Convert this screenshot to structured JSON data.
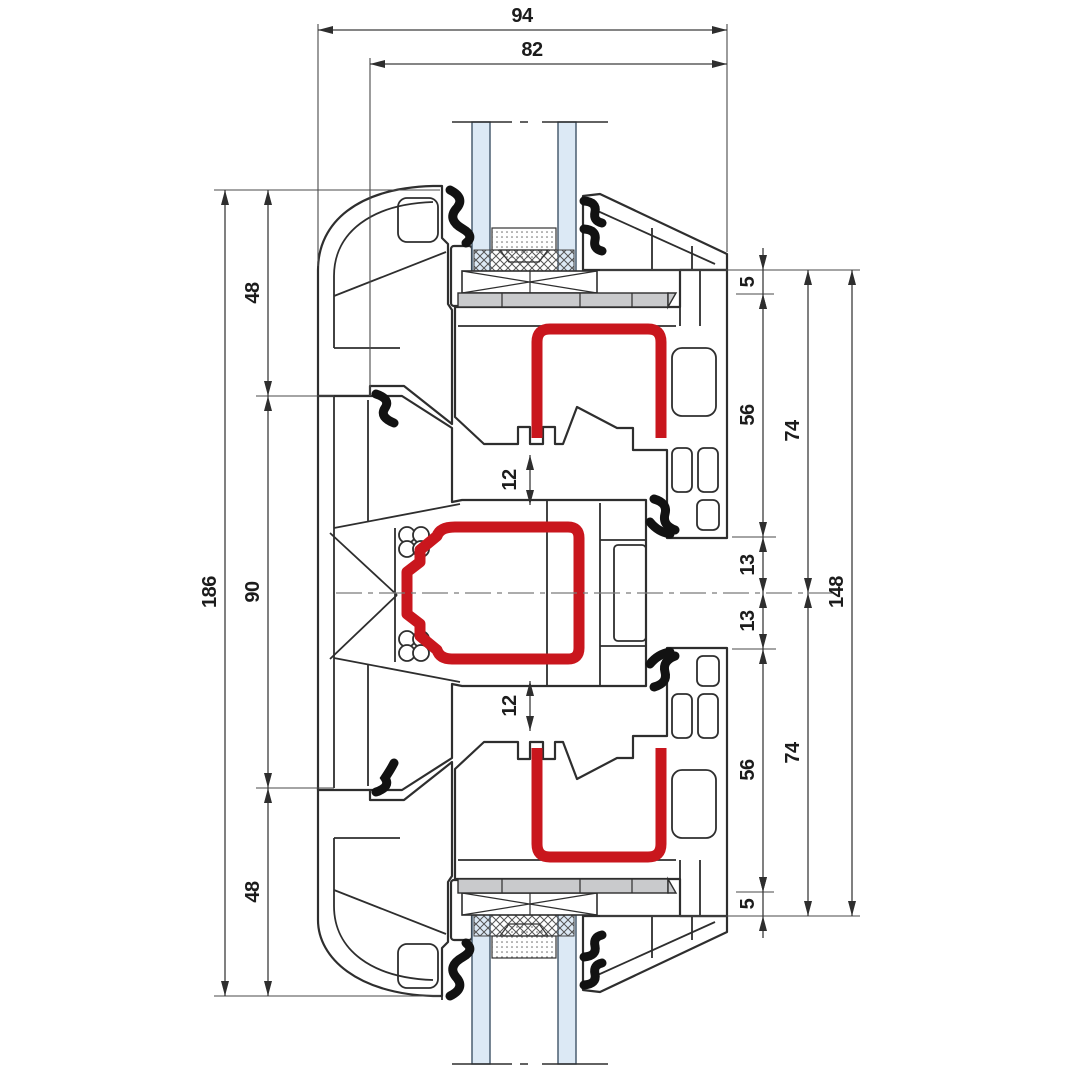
{
  "drawing": {
    "type": "technical-cross-section",
    "subject": "PVC window profile section: frame, mullion and two sashes with glazing",
    "units": "mm"
  },
  "colors": {
    "steel_red": "#c9161d",
    "glass_blue": "#dce9f5",
    "packer_gray": "#c9cacc",
    "gasket_black": "#121212",
    "outline": "#2e2e2e"
  },
  "dims": {
    "overall_depth": "94",
    "sash_depth": "82",
    "overall_height": "186",
    "frame_top": "48",
    "mullion_height": "90",
    "frame_bottom": "48",
    "gap_top": "12",
    "gap_bottom": "12",
    "edge_top": "5",
    "sash_top": "56",
    "rebate_top": "13",
    "rebate_bottom": "13",
    "sash_bottom": "56",
    "edge_bottom": "5",
    "half_top": "74",
    "half_bottom": "74",
    "total_right": "148"
  },
  "parts": {
    "frame": "outer frame profile",
    "mullion": "center mullion profile",
    "sash_top": "upper sash profile",
    "sash_bottom": "lower sash profile",
    "steel": "steel reinforcement",
    "glazing": "insulated glazing unit",
    "packer": "glazing packer",
    "gasket": "rubber gasket"
  }
}
